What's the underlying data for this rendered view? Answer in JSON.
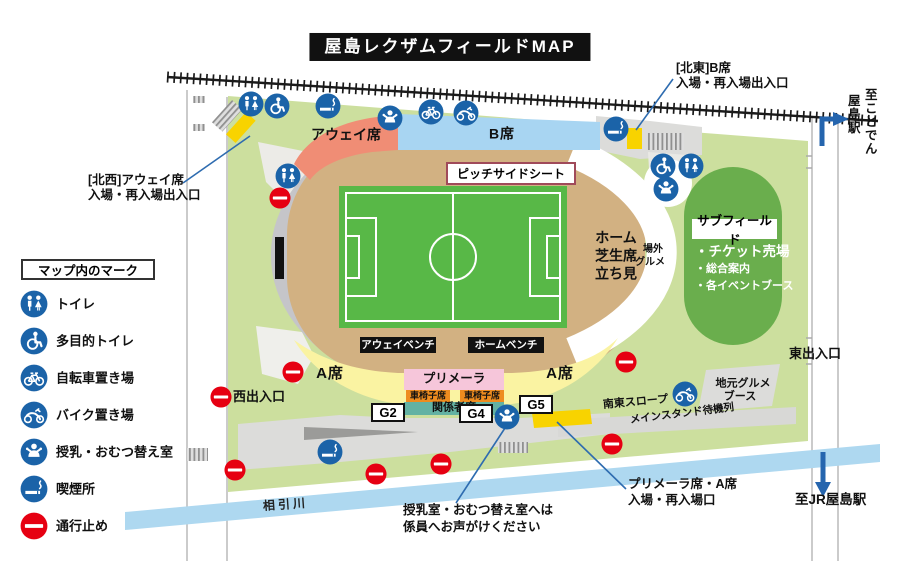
{
  "title": "屋島レクザムフィールドMAP",
  "legend": {
    "header": "マップ内のマーク",
    "items": [
      {
        "icon": "toilet-icon",
        "label": "トイレ"
      },
      {
        "icon": "accessible-toilet-icon",
        "label": "多目的トイレ"
      },
      {
        "icon": "bicycle-parking-icon",
        "label": "自転車置き場"
      },
      {
        "icon": "motorcycle-parking-icon",
        "label": "バイク置き場"
      },
      {
        "icon": "nursing-room-icon",
        "label": "授乳・おむつ替え室"
      },
      {
        "icon": "smoking-area-icon",
        "label": "喫煙所"
      },
      {
        "icon": "road-closed-icon",
        "label": "通行止め"
      }
    ]
  },
  "stadium": {
    "away_seats": "アウェイ席",
    "b_seats": "B席",
    "a_seats": "A席",
    "primera": "プリメーラ",
    "wheelchair_seats": "車椅子席",
    "officials_seats": "関係者席",
    "pitch_side_seat": "ピッチサイドシート",
    "away_bench": "アウェイベンチ",
    "home_bench": "ホームベンチ",
    "home_lawn": {
      "l1": "ホーム",
      "l2": "芝生席",
      "l3": "立ち見"
    },
    "outside_gourmet": {
      "l1": "場外",
      "l2": "グルメ"
    },
    "gate_g2": "G2",
    "gate_g4": "G4",
    "gate_g5": "G5"
  },
  "subfield": {
    "title": "サブフィールド",
    "item1": "・チケット売場",
    "item2": "・総合案内",
    "item3": "・各イベントブース"
  },
  "annotations": {
    "nw_gate": {
      "l1": "[北西]アウェイ席",
      "l2": "入場・再入場出入口"
    },
    "ne_gate": {
      "l1": "[北東]B席",
      "l2": "入場・再入場出入口"
    },
    "primera_gate": {
      "l1": "プリメーラ席・A席",
      "l2": "入場・再入場口"
    },
    "nursing_note": {
      "l1": "授乳室・おむつ替え室へは",
      "l2": "係員へお声がけください"
    }
  },
  "places": {
    "west_exit": "西出入口",
    "east_exit": "東出入口",
    "to_kotoden_line1": "至ことでん",
    "to_kotoden_line2": "屋島駅",
    "to_jr": "至JR屋島駅",
    "river": "相引川",
    "se_slope": "南東スロープ",
    "main_stand_queue": "メインスタンド待機列",
    "local_gourmet": {
      "l1": "地元グルメ",
      "l2": "ブース"
    }
  },
  "colors": {
    "map_green": "#ccdf9e",
    "subfield_green": "#6aae4d",
    "track_tan": "#d2b182",
    "pitch_green": "#58b847",
    "away_seat": "#f08d75",
    "b_seat": "#a8d5f2",
    "a_seat": "#faf3a2",
    "primera_pink": "#f6c6da",
    "wheelchair_orange": "#ee8c1f",
    "officials_teal": "#63b2a3",
    "river_blue": "#aed8f0",
    "gate_yellow": "#f8d300",
    "icon_blue": "#1b63a8",
    "no_entry_red": "#e60012",
    "callout_blue": "#2e6cb0"
  }
}
